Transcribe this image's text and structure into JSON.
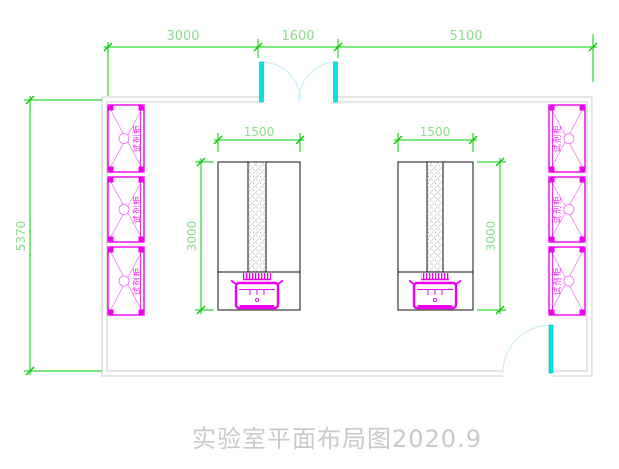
{
  "title": {
    "label": "实验室平面布局图2020.9"
  },
  "dimensions": {
    "top": [
      {
        "name": "left-bay",
        "label": "3000"
      },
      {
        "name": "door-bay",
        "label": "1600"
      },
      {
        "name": "right-bay",
        "label": "5100"
      }
    ],
    "left_wall": {
      "label": "5370"
    },
    "benches": {
      "left": {
        "width": "1500",
        "length": "3000"
      },
      "right": {
        "width": "1500",
        "length": "3000"
      }
    }
  },
  "cabinets": {
    "left": [
      {
        "label": "试剂柜"
      },
      {
        "label": "试剂柜"
      },
      {
        "label": "试剂柜"
      }
    ],
    "right": [
      {
        "label": "试剂柜"
      },
      {
        "label": "试剂柜"
      },
      {
        "label": "试剂柜"
      }
    ]
  },
  "colors": {
    "dimension_line": "#00cc00",
    "dimension_text": "#8ddb8d",
    "cabinet_magenta": "#ee00ee",
    "door_leaf_cyan": "#00e6e6",
    "door_swing_arc": "#c5ecf5",
    "wall_gray": "#cccccc",
    "bench_outline": "#000000",
    "title_gray": "#c9c9c9"
  }
}
